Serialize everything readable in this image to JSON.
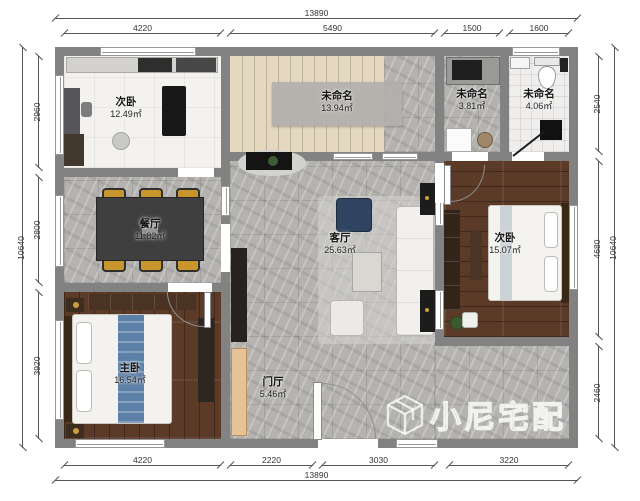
{
  "watermark": {
    "brand": "小尼宅配"
  },
  "dimensions": {
    "top": {
      "total": "13890",
      "segments": [
        "4220",
        "5490",
        "1500",
        "1600"
      ]
    },
    "bottom": {
      "total": "13890",
      "segments": [
        "4220",
        "2220",
        "3030",
        "3220"
      ]
    },
    "left": {
      "total": "10640",
      "segments": [
        "2960",
        "2800",
        "3920"
      ]
    },
    "right": {
      "total": "10640",
      "segments": [
        "2540",
        "4680",
        "2460"
      ]
    }
  },
  "rooms": [
    {
      "name": "次卧",
      "area": "12.49㎡"
    },
    {
      "name": "未命名",
      "area": "13.94㎡"
    },
    {
      "name": "未命名",
      "area": "3.81㎡"
    },
    {
      "name": "未命名",
      "area": "4.06㎡"
    },
    {
      "name": "餐厅",
      "area": "11.82㎡"
    },
    {
      "name": "客厅",
      "area": "25.63㎡"
    },
    {
      "name": "次卧",
      "area": "15.07㎡"
    },
    {
      "name": "主卧",
      "area": "16.54㎡"
    },
    {
      "name": "门厅",
      "area": "5.46㎡"
    }
  ],
  "colors": {
    "wall": "#828282",
    "marble_floor": "#b5b3b0",
    "wood_floor": "#5b3a27",
    "stair_beige": "#e4d8bf",
    "accent_gold": "#c9962e",
    "watermark": "#ffffff"
  }
}
